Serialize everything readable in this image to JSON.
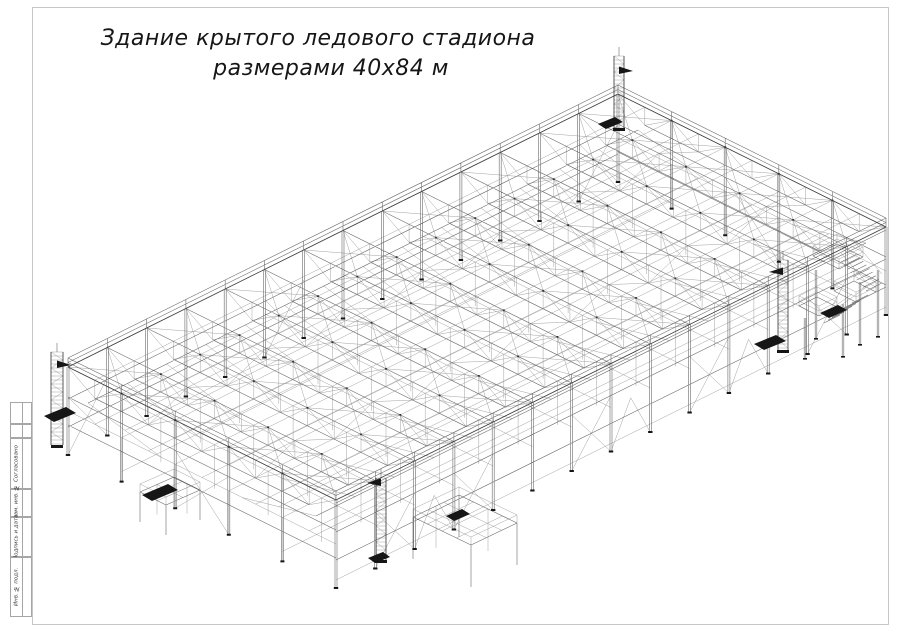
{
  "drawing_title": {
    "line1": "Здание крытого ледового стадиона",
    "line2": "размерами 40х84 м"
  },
  "title_block": {
    "labels": [
      "Согласовано",
      "Взам. инв. №",
      "Подпись и дата",
      "Инв. № подл."
    ]
  },
  "page": {
    "background": "#ffffff",
    "frame_color": "#c6c6c6"
  },
  "model": {
    "origin": [
      68,
      455
    ],
    "u_vec": [
      6.548,
      -3.25
    ],
    "v_vec": [
      6.7,
      3.325
    ],
    "length": 84,
    "width": 40,
    "bays": 14,
    "width_bays": 5,
    "roof_z": 88,
    "truss_bottom_z": 70,
    "mid_z": 44,
    "colors": {
      "thin": "#979797",
      "med": "#6a6a6a",
      "main": "#3f3f3f",
      "dark": "#161616",
      "dots": "#333333"
    },
    "towers": [
      {
        "name": "tower-left",
        "x": 57,
        "w": 12,
        "top": 352,
        "base": 445,
        "flag": "right",
        "flag_y": 365
      },
      {
        "name": "tower-north",
        "x": 619,
        "w": 10,
        "top": 56,
        "base": 128,
        "flag": "right",
        "flag_y": 71
      },
      {
        "name": "tower-right",
        "x": 783,
        "w": 10,
        "top": 260,
        "base": 350,
        "flag": "left",
        "flag_y": 272
      },
      {
        "name": "tower-front",
        "x": 381,
        "w": 10,
        "top": 478,
        "base": 560,
        "flag": "left",
        "flag_y": 483
      }
    ],
    "decks": [
      {
        "name": "deck-front",
        "p": [
          413,
          517
        ],
        "du": [
          46,
          -22
        ],
        "dv": [
          58,
          28
        ],
        "post_h": 42,
        "nu": 3,
        "nv": 4
      },
      {
        "name": "deck-balcony",
        "p": [
          140,
          492
        ],
        "du": [
          34,
          -15
        ],
        "dv": [
          26,
          13
        ],
        "post_h": 30,
        "nu": 2,
        "nv": 3
      }
    ],
    "stairs": {
      "landings": [
        {
          "p": [
            813,
            256
          ],
          "a": [
            24,
            -12
          ],
          "b": [
            26,
            13
          ]
        },
        {
          "p": [
            834,
            291
          ],
          "a": [
            20,
            -10
          ],
          "b": [
            22,
            11
          ]
        },
        {
          "p": [
            799,
            306
          ],
          "a": [
            18,
            -9
          ],
          "b": [
            20,
            10
          ]
        }
      ],
      "flights": [
        {
          "s": [
            841,
            262
          ],
          "e": [
            866,
            291
          ],
          "step": [
            16,
            -8
          ],
          "n": 8
        },
        {
          "s": [
            852,
            303
          ],
          "e": [
            824,
            323
          ],
          "step": [
            16,
            -8
          ],
          "n": 7
        }
      ],
      "posts": [
        [
          816,
          270,
          338
        ],
        [
          860,
          282,
          344
        ],
        [
          843,
          304,
          356
        ],
        [
          805,
          318,
          358
        ],
        [
          878,
          270,
          336
        ]
      ]
    },
    "grates": [
      {
        "p": [
          44,
          416
        ],
        "a": [
          22,
          -9
        ],
        "b": [
          10,
          6
        ]
      },
      {
        "p": [
          142,
          495
        ],
        "a": [
          26,
          -11
        ],
        "b": [
          10,
          6
        ]
      },
      {
        "p": [
          754,
          344
        ],
        "a": [
          22,
          -9
        ],
        "b": [
          10,
          6
        ]
      },
      {
        "p": [
          820,
          313
        ],
        "a": [
          18,
          -8
        ],
        "b": [
          9,
          5
        ]
      },
      {
        "p": [
          368,
          558
        ],
        "a": [
          15,
          -6
        ],
        "b": [
          7,
          5
        ]
      },
      {
        "p": [
          446,
          516
        ],
        "a": [
          16,
          -7
        ],
        "b": [
          8,
          5
        ]
      },
      {
        "p": [
          598,
          124
        ],
        "a": [
          17,
          -7
        ],
        "b": [
          8,
          5
        ]
      }
    ]
  }
}
